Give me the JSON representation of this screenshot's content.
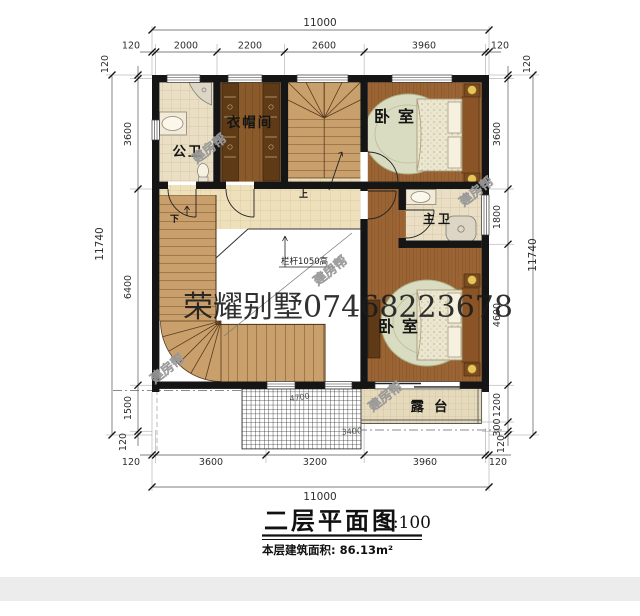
{
  "watermark": {
    "brand": "荣耀别墅07468223678",
    "stamp": "建房帮"
  },
  "rooms": {
    "public_bath": "公卫",
    "cloakroom": "衣帽间",
    "bedroom_top": "卧室",
    "master_bath": "主卫",
    "bedroom_bottom": "卧室",
    "terrace": "露台"
  },
  "annotations": {
    "railing_height": "栏杆1050高",
    "stair_up": "上",
    "stair_down": "下",
    "lattice_dim_a": "4700",
    "lattice_dim_b": "3400"
  },
  "dimensions": {
    "top_total": "11000",
    "top": [
      "120",
      "2000",
      "2200",
      "2600",
      "3960",
      "120"
    ],
    "bottom_total": "11000",
    "bottom": [
      "120",
      "3600",
      "3200",
      "3960",
      "120"
    ],
    "left_total": "11740",
    "left": [
      "120",
      "3600",
      "6400",
      "1500",
      "120"
    ],
    "right_total": "11740",
    "right": [
      "120",
      "3600",
      "1800",
      "4600",
      "1200",
      "300",
      "120"
    ]
  },
  "title": {
    "name": "二层平面图",
    "scale": "1:100",
    "area": "本层建筑面积: 86.13m²"
  },
  "colors": {
    "wall": "#151515",
    "wood": "#9a6434",
    "tile": "#eadfc4",
    "gold": "#e8c45c"
  }
}
